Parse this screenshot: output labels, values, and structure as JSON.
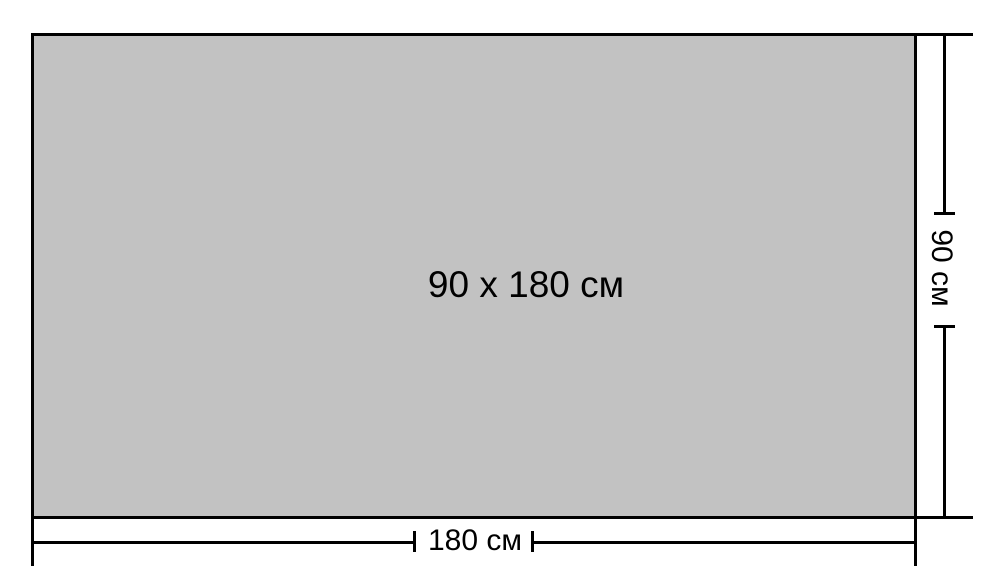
{
  "diagram": {
    "center_label": "90 х 180 см",
    "width_dimension": {
      "label": "180 см"
    },
    "height_dimension": {
      "label": "90 см"
    },
    "colors": {
      "rect_fill": "#c2c2c2",
      "line": "#000000",
      "background": "#ffffff"
    }
  }
}
